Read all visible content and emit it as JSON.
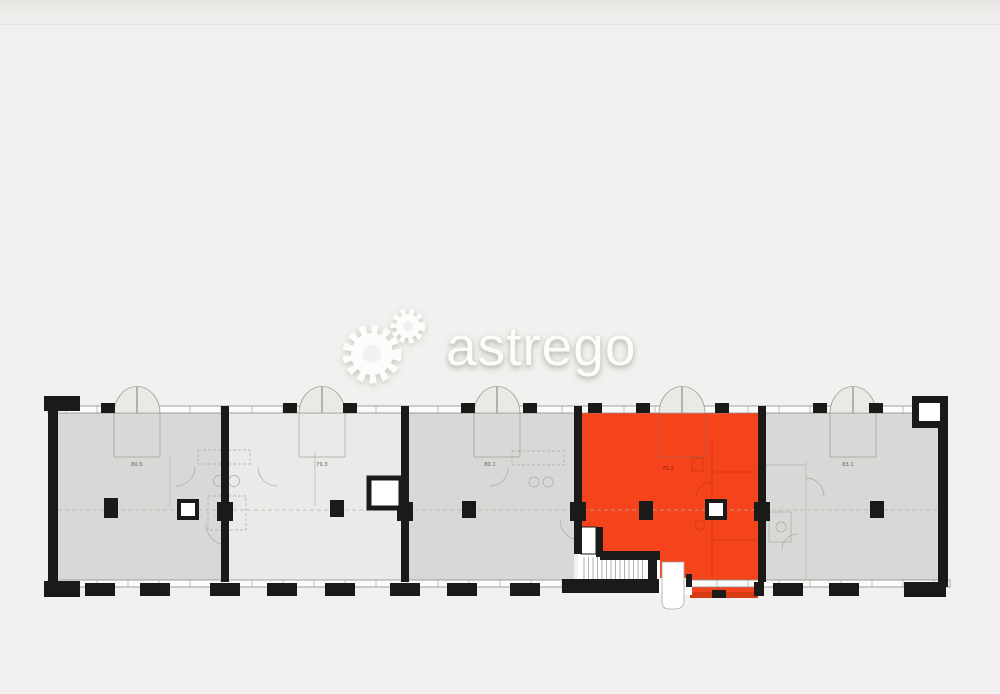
{
  "watermark": {
    "brand": "astrego",
    "logo_icon": "gears-icon"
  },
  "plan": {
    "type": "building-floor-plan",
    "selected_unit": "unit-4",
    "units": [
      {
        "id": "unit-1",
        "label": "80.5",
        "state": "available",
        "fill": "dark"
      },
      {
        "id": "unit-2",
        "label": "79.3",
        "state": "available",
        "fill": "light"
      },
      {
        "id": "unit-3",
        "label": "80.1",
        "state": "available",
        "fill": "dark"
      },
      {
        "id": "unit-4",
        "label": "70.1",
        "state": "selected",
        "fill": "selected"
      },
      {
        "id": "unit-5",
        "label": "83.1",
        "state": "available",
        "fill": "dark"
      }
    ],
    "features": [
      "entrance-double-doors-top",
      "stairwell-bottom-center",
      "shaft-boxes",
      "structural-columns-midline"
    ],
    "colors": {
      "selected": "#f5431c",
      "selected_dark": "#d63b14",
      "unit_dark": "#d8d9d6",
      "unit_light": "#eaebe8",
      "wall": "#1a1a18",
      "background": "#f2f1ef"
    }
  }
}
